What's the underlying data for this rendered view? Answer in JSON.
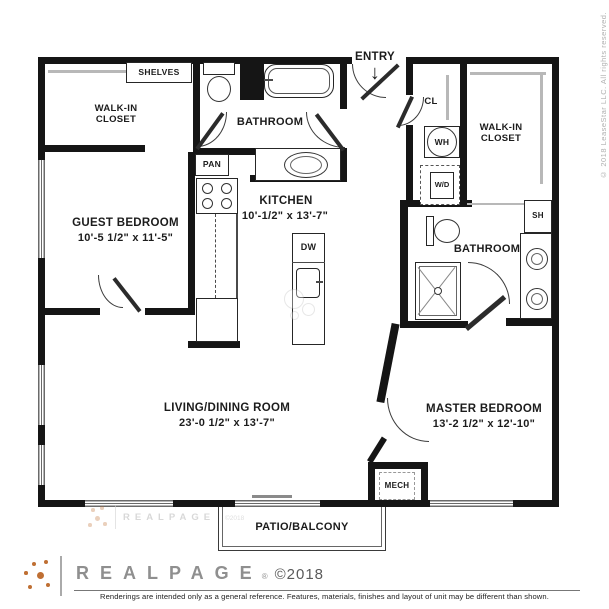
{
  "plan": {
    "entry": {
      "label": "ENTRY",
      "arrow": "↓"
    },
    "rooms": {
      "wic_left": {
        "label": "WALK-IN\nCLOSET"
      },
      "bath_top": {
        "label": "BATHROOM"
      },
      "kitchen": {
        "label": "KITCHEN",
        "dims": "10'-1/2\" x 13'-7\""
      },
      "guest": {
        "label": "GUEST BEDROOM",
        "dims": "10'-5 1/2\" x 11'-5\""
      },
      "wic_right": {
        "label": "WALK-IN\nCLOSET"
      },
      "bath_right": {
        "label": "BATHROOM"
      },
      "living": {
        "label": "LIVING/DINING ROOM",
        "dims": "23'-0 1/2\" x 13'-7\""
      },
      "master": {
        "label": "MASTER BEDROOM",
        "dims": "13'-2 1/2\" x 12'-10\""
      },
      "patio": {
        "label": "PATIO/BALCONY"
      }
    },
    "fixtures": {
      "shelves": "SHELVES",
      "pan": "PAN",
      "dw": "DW",
      "wh": "WH",
      "wd": "W/D",
      "cl": "CL",
      "sh": "SH",
      "mech": "MECH"
    }
  },
  "watermark": {
    "logo": "REALPAGE",
    "copyright": "©2018"
  },
  "footer": {
    "logo": "REALPAGE",
    "reg": "®",
    "copyright": "©2018",
    "disclaimer": "Renderings are intended only as a general reference. Features, materials, finishes and layout of unit may be different than shown."
  },
  "side": {
    "copyright": "© 2018 LeaseStar LLC. All rights reserved."
  },
  "colors": {
    "wall": "#151515",
    "accent": "#bf6f33",
    "logo_gray": "#8f8f8f"
  }
}
